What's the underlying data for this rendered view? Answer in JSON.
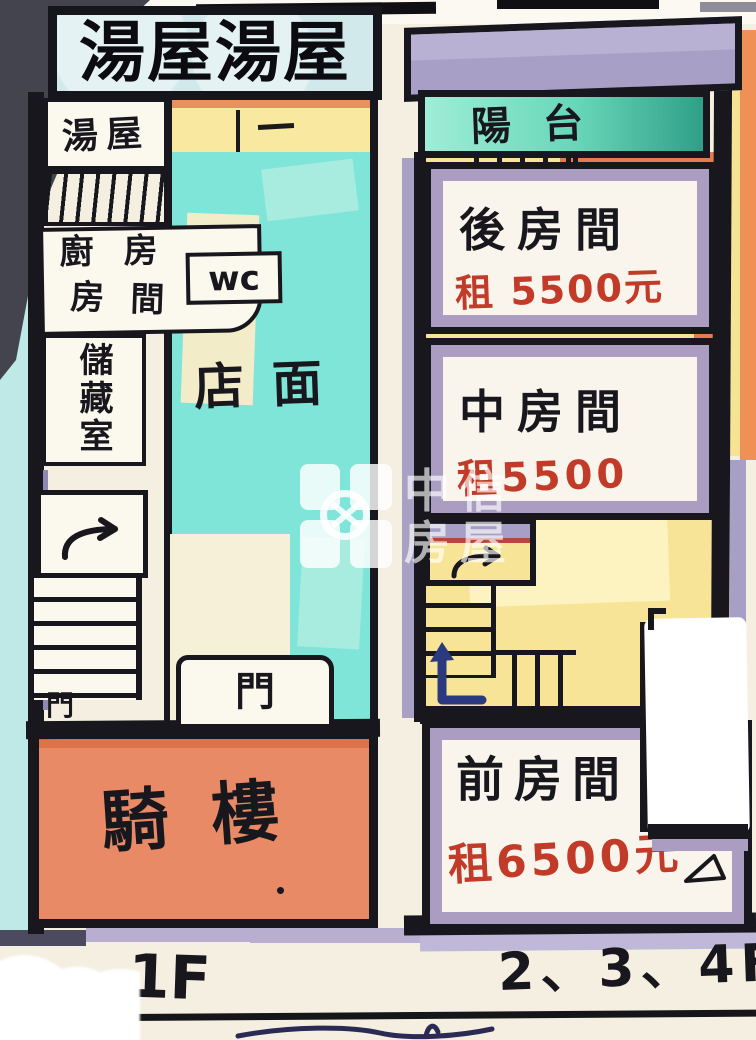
{
  "banner": {
    "title": "湯屋湯屋"
  },
  "left_plan": {
    "floor_label": "1F",
    "soup_room": "湯屋",
    "kitchen": "廚房",
    "bedroom": "房間",
    "wc": "wc",
    "storage": "儲藏室",
    "storefront": "店面",
    "arcade": "騎樓",
    "door_stairs": "門",
    "door_store": "門"
  },
  "right_plan": {
    "floor_label": "2、3、4F",
    "balcony": "陽台",
    "rooms": [
      {
        "name": "後房間",
        "rent": "租 5500元"
      },
      {
        "name": "中房間",
        "rent": "租5500"
      },
      {
        "name": "前房間",
        "rent": "租6500元"
      }
    ]
  },
  "watermark": {
    "brand": "中信房屋",
    "line1": "中信",
    "line2": "房屋"
  },
  "colors": {
    "wall_black": "#17171d",
    "teal_floor": "#7fe5d9",
    "yellow_floor": "#f7e496",
    "salmon_arcade": "#e88a65",
    "purple_trim": "#ab9dc2",
    "balcony_teal": "#67d6b8",
    "rent_red": "#c23a28",
    "arrow_navy": "#2b3a80",
    "cream_bg": "#f4efe0",
    "cyan_bg": "#bfe9e6"
  }
}
